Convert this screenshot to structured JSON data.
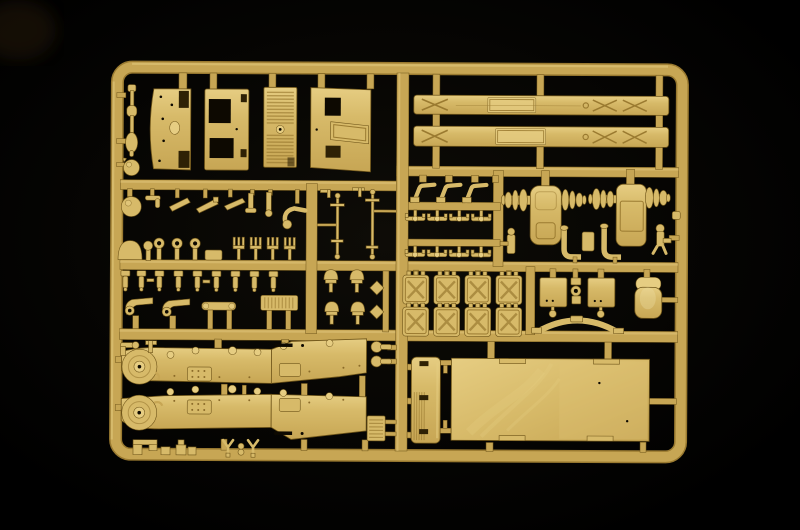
{
  "meta": {
    "type": "photograph",
    "subject": "Injection-molded plastic model kit sprue in sand-yellow plastic on a black background",
    "alt": "A rectangular sand-yellow model kit sprue frame filled with unpainted parts: hull panels, louvered grille, two long chassis rails, axle housings, jerry cans, leaf spring, seat, two fenders with round wheel discs, a slatted tailgate and a large cargo bed floor, plus many small fittings"
  },
  "palette": {
    "bg": "#000000",
    "plastic_hi": "#e6cd82",
    "plastic_light": "#d7ba69",
    "plastic_mid": "#c7a654",
    "plastic_dark": "#9a7a30",
    "plastic_shadow": "#6f5519",
    "slot_dark": "#2e2105",
    "hole_black": "#0d0901"
  },
  "sprue": {
    "material_color_name": "sand yellow (desert tan) styrene",
    "frame_shape": "rounded rectangle with internal runner lattice",
    "parts_inventory": [
      {
        "name": "suspension-damper-rod",
        "count": 1,
        "zone": "upper-left edge"
      },
      {
        "name": "ball-knob",
        "count": 1,
        "zone": "upper-left edge"
      },
      {
        "name": "hull-side-panel",
        "count": 1,
        "zone": "top row"
      },
      {
        "name": "twin-window-panel",
        "count": 1,
        "zone": "top row"
      },
      {
        "name": "louvered-grille-panel",
        "count": 1,
        "zone": "top row"
      },
      {
        "name": "windshield-frame-panel",
        "count": 1,
        "zone": "top row"
      },
      {
        "name": "chassis-rail",
        "count": 2,
        "zone": "top right"
      },
      {
        "name": "small-lever",
        "count": 8,
        "zone": "middle-left row 1"
      },
      {
        "name": "knob-fitting",
        "count": 5,
        "zone": "middle-left row 2"
      },
      {
        "name": "ring-cap",
        "count": 3,
        "zone": "middle-left row 2"
      },
      {
        "name": "fork-bracket",
        "count": 4,
        "zone": "middle-left row 2"
      },
      {
        "name": "bolt-pin",
        "count": 9,
        "zone": "middle-left row 3"
      },
      {
        "name": "tow-hook",
        "count": 2,
        "zone": "middle-left row 4"
      },
      {
        "name": "tie-bar",
        "count": 1,
        "zone": "middle-left row 4"
      },
      {
        "name": "vent-plate",
        "count": 1,
        "zone": "middle-left row 4"
      },
      {
        "name": "tie-rod",
        "count": 2,
        "zone": "middle box"
      },
      {
        "name": "z-bracket",
        "count": 3,
        "zone": "middle center"
      },
      {
        "name": "winged-clip",
        "count": 8,
        "zone": "middle center"
      },
      {
        "name": "axle-housing-assembly",
        "count": 2,
        "zone": "middle right"
      },
      {
        "name": "exhaust-pipe",
        "count": 2,
        "zone": "middle right"
      },
      {
        "name": "junction-box",
        "count": 1,
        "zone": "middle right"
      },
      {
        "name": "pawl-fitting",
        "count": 2,
        "zone": "right edge"
      },
      {
        "name": "jerry-can",
        "count": 8,
        "zone": "lower middle grid"
      },
      {
        "name": "hatch-panel",
        "count": 2,
        "zone": "lower middle"
      },
      {
        "name": "linkage-stack",
        "count": 1,
        "zone": "lower middle"
      },
      {
        "name": "leaf-spring",
        "count": 1,
        "zone": "lower middle"
      },
      {
        "name": "seat",
        "count": 1,
        "zone": "lower middle right"
      },
      {
        "name": "bell-lamp",
        "count": 4,
        "zone": "lower middle left"
      },
      {
        "name": "reflector-diamond",
        "count": 2,
        "zone": "lower middle left"
      },
      {
        "name": "mirror-dumbbell",
        "count": 2,
        "zone": "bottom center"
      },
      {
        "name": "fender-with-wheel-disc",
        "count": 2,
        "zone": "bottom left"
      },
      {
        "name": "small-vent-grille",
        "count": 1,
        "zone": "bottom center"
      },
      {
        "name": "slatted-tailgate",
        "count": 1,
        "zone": "bottom right"
      },
      {
        "name": "cargo-bed-floor",
        "count": 1,
        "zone": "bottom right"
      },
      {
        "name": "small-bracket",
        "count": 6,
        "zone": "bottom edge"
      }
    ]
  }
}
